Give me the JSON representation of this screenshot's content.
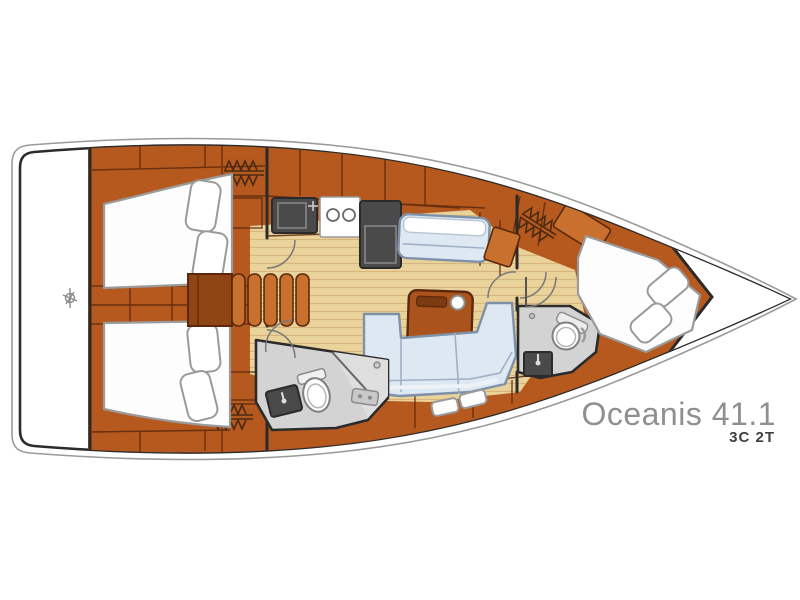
{
  "label": {
    "model": "Oceanis 41.1",
    "variant": "3C 2T"
  },
  "colors": {
    "hull-outer": "#9a9a9a",
    "wall": "#2b2b2b",
    "wood": "#b5591f",
    "wood-light": "#c9702f",
    "wood-deep": "#8f4514",
    "wood-line": "#5c280c",
    "floor": "#ead29b",
    "floor-line": "#d6b67c",
    "bed": "#fdfdfd",
    "bed-line": "#9a9a9a",
    "settee": "#dde8f3",
    "settee-line": "#9fb0c4",
    "settee-border": "#7e91a8",
    "appliance": "#4a4a4a",
    "appliance-line": "#2b2b2b",
    "head-floor": "#d3d3d3",
    "fixture-line": "#808080",
    "label-model": "#8f8f8f",
    "label-variant": "#3f3f3f"
  }
}
